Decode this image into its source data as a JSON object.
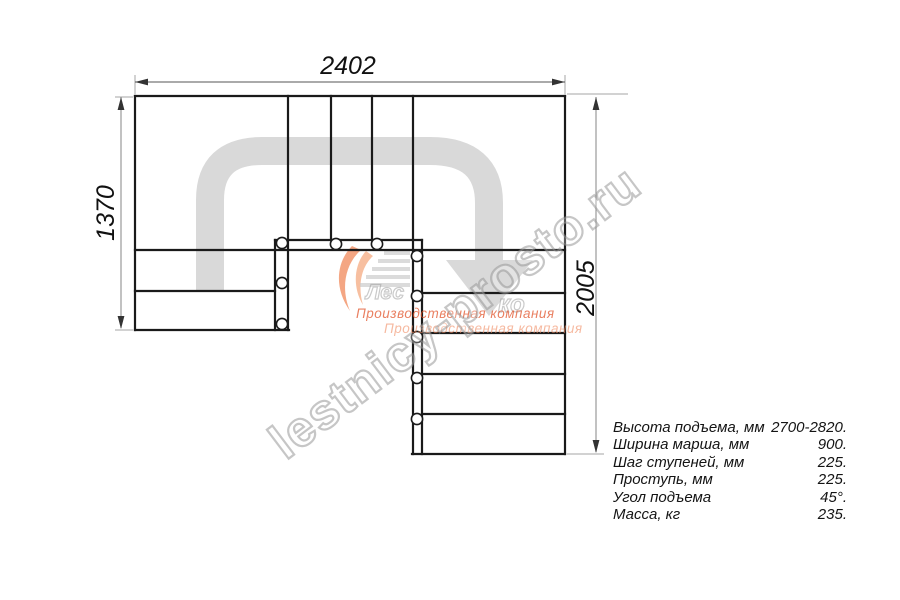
{
  "drawing": {
    "dim_width": "2402",
    "dim_height_left": "1370",
    "dim_height_right": "2005"
  },
  "specs": {
    "rows": [
      {
        "label": "Высота подъема, мм",
        "value": "2700-2820."
      },
      {
        "label": "Ширина марша, мм",
        "value": "900."
      },
      {
        "label": "Шаг ступеней, мм",
        "value": "225."
      },
      {
        "label": "Проступь, мм",
        "value": "225."
      },
      {
        "label": "Угол подъема",
        "value": "45°."
      },
      {
        "label": "Масса, кг",
        "value": "235."
      }
    ]
  },
  "watermark": {
    "site": "lestnicy-prosto.ru",
    "logo_text_1": "Лес",
    "logo_text_2": "ко",
    "slogan_line1": "Производственная компания",
    "slogan_line2": "Производственная компания"
  },
  "colors": {
    "drawing_line": "#1a1a1a",
    "walk_arrow_gray": "#d9d9d9",
    "dimension_line": "#555555",
    "extension_line": "#a6a6a6",
    "watermark_gray": "#919191",
    "logo_orange": "#ec6a30",
    "logo_orange_light": "#f08a52"
  }
}
